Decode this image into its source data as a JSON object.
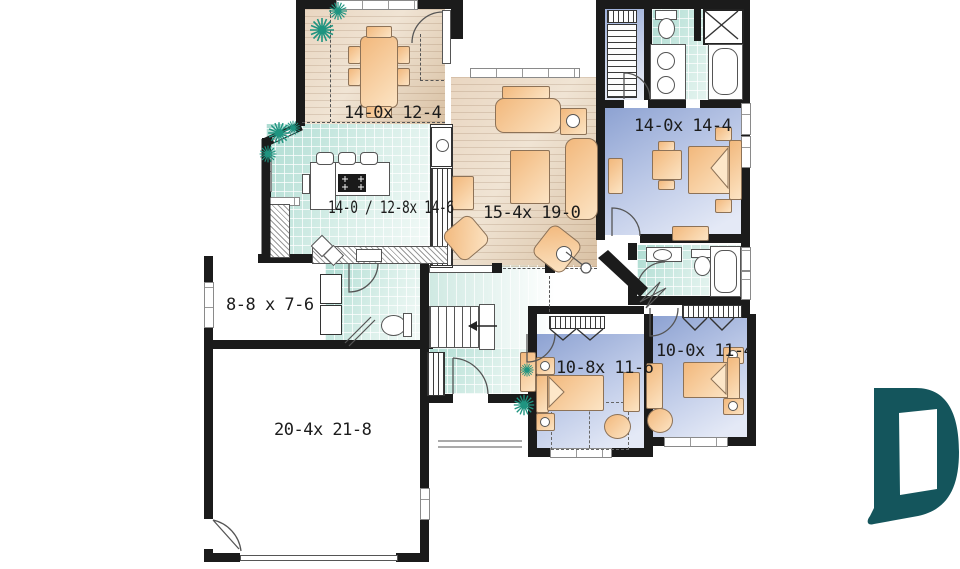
{
  "plan": {
    "type": "house-floor-plan",
    "wall_color": "#1b1b1b",
    "wood_floor_color": "#e3cfb8",
    "tile_floor_color": "#bfe3da",
    "carpet_floor_color": "#a9bade",
    "furniture_color": "#f5c48e",
    "plant_color": "#1f9480"
  },
  "rooms": {
    "dining": {
      "name": "dining-room",
      "label": "14-0x 12-4"
    },
    "kitchen": {
      "name": "kitchen",
      "label": "14-0 / 12-8x 14-6"
    },
    "living": {
      "name": "living-room",
      "label": "15-4x 19-0"
    },
    "master_bedroom": {
      "name": "master-bedroom",
      "label": "14-0x 14-4"
    },
    "storage": {
      "name": "storage-room",
      "label": "8-8 x 7-6"
    },
    "garage": {
      "name": "garage",
      "label": "20-4x 21-8"
    },
    "bedroom_2": {
      "name": "bedroom-2",
      "label": "10-8x 11-6"
    },
    "bedroom_3": {
      "name": "bedroom-3",
      "label": "10-0x 11-4"
    }
  },
  "logo": {
    "shape": "letter-D-doorway",
    "color": "#14555c"
  }
}
